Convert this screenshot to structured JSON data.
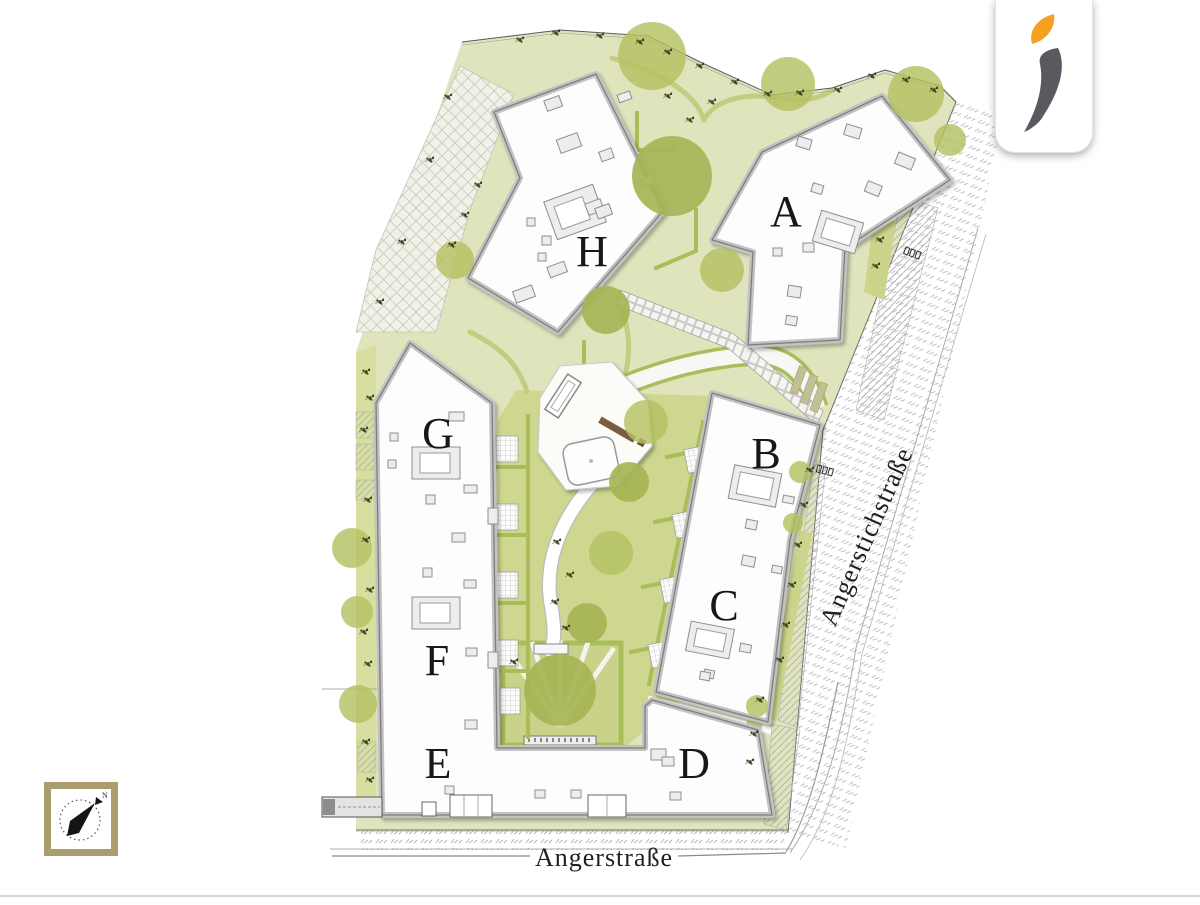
{
  "plan": {
    "building_labels": [
      {
        "id": "A"
      },
      {
        "id": "B"
      },
      {
        "id": "C"
      },
      {
        "id": "D"
      },
      {
        "id": "E"
      },
      {
        "id": "F"
      },
      {
        "id": "G"
      },
      {
        "id": "H"
      }
    ],
    "streets": {
      "right": {
        "label": "Angerstichstraße"
      },
      "bottom": {
        "label": "Angerstraße"
      }
    },
    "compass": {
      "north_label": "N"
    },
    "colors": {
      "site_green": "#e0e4bd",
      "lawn_green": "#ced68f",
      "garden_green": "#c9d288",
      "tree_green": "#b4c162",
      "hedge_green": "#a9bd5b",
      "building_fill": "#fdfdfd",
      "building_outline": "#7e7e7e",
      "compass_frame": "#ab9e6e",
      "logo_orange": "#f5a11f",
      "logo_gray": "#595a60"
    }
  }
}
